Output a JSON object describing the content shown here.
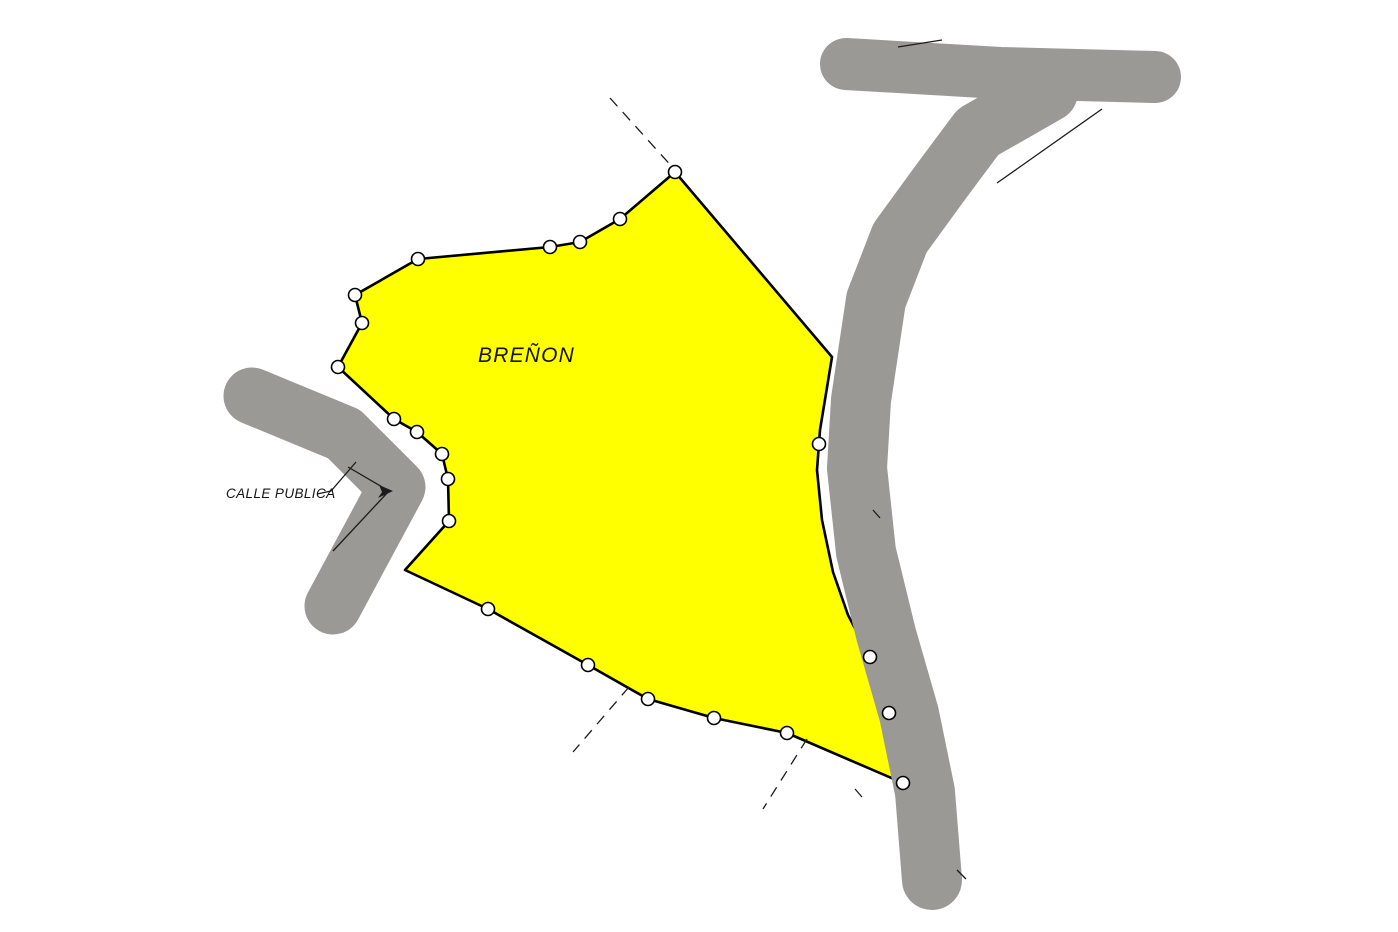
{
  "parcel": {
    "label": "BREÑON"
  },
  "street": {
    "label": "CALLE PUBLICA"
  },
  "colors": {
    "background": "#ffffff",
    "parcel_fill": "#ffff00",
    "outline": "#000000",
    "road": "#9a9996",
    "line": "#1c1c1c"
  },
  "geometry": {
    "parcel_points": [
      [
        675,
        172
      ],
      [
        832,
        357
      ],
      [
        820,
        430
      ],
      [
        817,
        470
      ],
      [
        822,
        520
      ],
      [
        833,
        572
      ],
      [
        848,
        615
      ],
      [
        870,
        657
      ],
      [
        889,
        713
      ],
      [
        903,
        783
      ],
      [
        787,
        733
      ],
      [
        714,
        718
      ],
      [
        648,
        699
      ],
      [
        588,
        665
      ],
      [
        488,
        609
      ],
      [
        405,
        570
      ],
      [
        449,
        521
      ],
      [
        448,
        479
      ],
      [
        442,
        454
      ],
      [
        417,
        432
      ],
      [
        394,
        419
      ],
      [
        338,
        367
      ],
      [
        362,
        323
      ],
      [
        355,
        295
      ],
      [
        418,
        259
      ],
      [
        550,
        247
      ],
      [
        580,
        242
      ],
      [
        620,
        219
      ]
    ],
    "roads": [
      {
        "name": "road-calle-publica",
        "width": 57,
        "points": [
          [
            252,
            396
          ],
          [
            344,
            434
          ],
          [
            397,
            487
          ],
          [
            333,
            606
          ]
        ]
      },
      {
        "name": "road-right-main",
        "width": 60,
        "points": [
          [
            1048,
            92
          ],
          [
            978,
            132
          ],
          [
            940,
            183
          ],
          [
            900,
            238
          ],
          [
            876,
            300
          ],
          [
            861,
            400
          ],
          [
            857,
            468
          ],
          [
            866,
            552
          ],
          [
            886,
            634
          ],
          [
            909,
            714
          ],
          [
            925,
            792
          ],
          [
            932,
            880
          ]
        ]
      },
      {
        "name": "road-right-branch",
        "width": 52,
        "points": [
          [
            846,
            64
          ],
          [
            1000,
            73
          ],
          [
            1155,
            77
          ]
        ]
      }
    ],
    "solid_lines": [
      {
        "name": "street-leader-line",
        "points": [
          [
            317,
            494
          ],
          [
            331,
            491
          ],
          [
            356,
            462
          ]
        ]
      },
      {
        "name": "street-notch-line",
        "points": [
          [
            348,
            467
          ],
          [
            389,
            491
          ],
          [
            333,
            551
          ]
        ]
      },
      {
        "name": "survey-line-junction",
        "points": [
          [
            1102,
            109
          ],
          [
            997,
            183
          ]
        ]
      },
      {
        "name": "survey-line-branch-top",
        "points": [
          [
            898,
            47
          ],
          [
            942,
            40
          ]
        ]
      },
      {
        "name": "survey-tick-1",
        "points": [
          [
            873,
            510
          ],
          [
            880,
            518
          ]
        ]
      },
      {
        "name": "survey-tick-2",
        "points": [
          [
            957,
            870
          ],
          [
            966,
            879
          ]
        ]
      },
      {
        "name": "survey-tick-3",
        "points": [
          [
            855,
            789
          ],
          [
            862,
            797
          ]
        ]
      }
    ],
    "dashed_lines": [
      {
        "name": "dashed-extension-top",
        "points": [
          [
            610,
            98
          ],
          [
            674,
            169
          ]
        ]
      },
      {
        "name": "dashed-extension-bottom-left",
        "points": [
          [
            629,
            687
          ],
          [
            573,
            752
          ]
        ]
      },
      {
        "name": "dashed-extension-bottom-right",
        "points": [
          [
            807,
            739
          ],
          [
            763,
            809
          ]
        ]
      }
    ],
    "leader_arrowhead": [
      [
        393,
        491
      ],
      [
        379,
        485
      ],
      [
        382,
        492
      ],
      [
        378,
        498
      ]
    ],
    "vertices": [
      [
        675,
        172
      ],
      [
        620,
        219
      ],
      [
        580,
        242
      ],
      [
        550,
        247
      ],
      [
        418,
        259
      ],
      [
        355,
        295
      ],
      [
        362,
        323
      ],
      [
        338,
        367
      ],
      [
        394,
        419
      ],
      [
        417,
        432
      ],
      [
        442,
        454
      ],
      [
        448,
        479
      ],
      [
        449,
        521
      ],
      [
        488,
        609
      ],
      [
        588,
        665
      ],
      [
        648,
        699
      ],
      [
        714,
        718
      ],
      [
        787,
        733
      ],
      [
        903,
        783
      ],
      [
        889,
        713
      ],
      [
        870,
        657
      ],
      [
        819,
        444
      ]
    ],
    "vertex_radius": 6.5
  }
}
